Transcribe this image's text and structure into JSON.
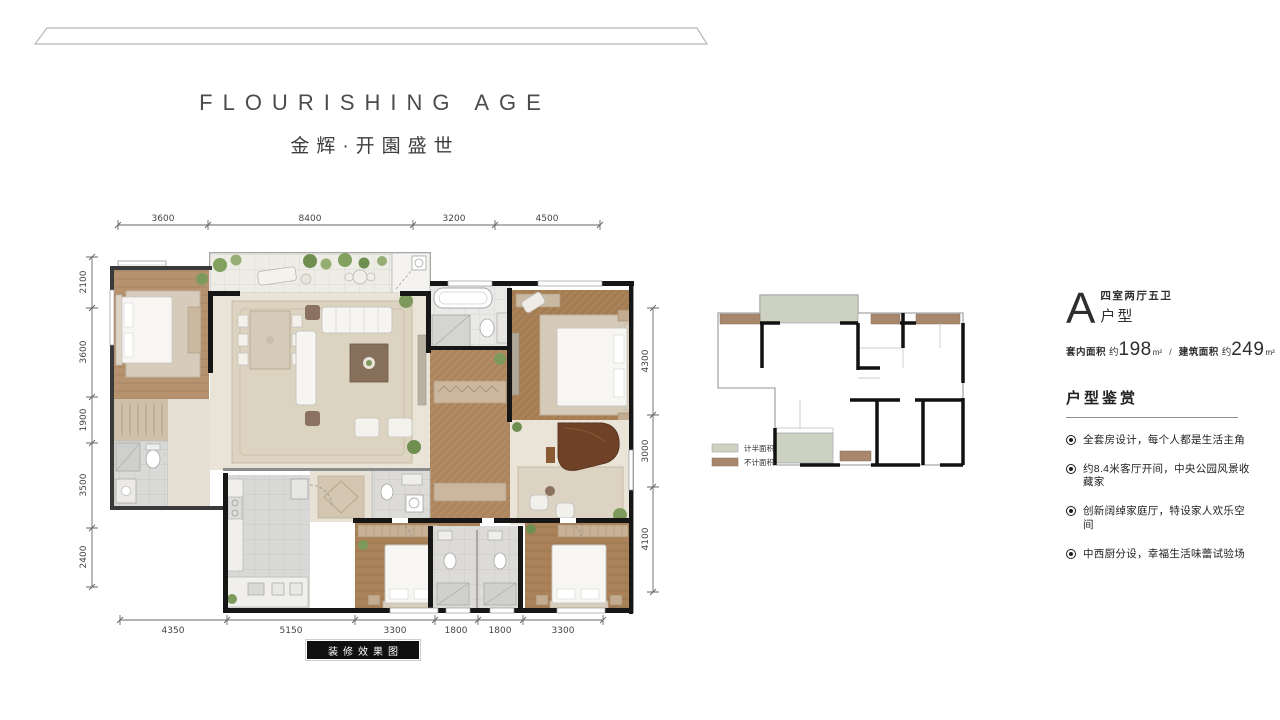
{
  "header": {
    "title_en": "FLOURISHING AGE",
    "title_cn": "金辉·开園盛世"
  },
  "plan": {
    "caption": "装修效果图",
    "dims_top": [
      "3600",
      "8400",
      "3200",
      "4500"
    ],
    "dims_left": [
      "2100",
      "3600",
      "1900",
      "3500",
      "2400"
    ],
    "dims_right": [
      "4300",
      "3000",
      "4100"
    ],
    "dims_bottom": [
      "4350",
      "5150",
      "3300",
      "1800",
      "1800",
      "3300"
    ]
  },
  "legend": {
    "items": [
      {
        "label": "计半面积",
        "color": "#ccd1c2"
      },
      {
        "label": "不计面积",
        "color": "#a8876c"
      }
    ]
  },
  "unit": {
    "letter": "A",
    "rooms": "四室两厅五卫",
    "label": "户型",
    "area_prefix_1": "套内面积",
    "area_approx_1": "约",
    "area_value_1": "198",
    "area_unit_1": "m²",
    "area_sep": "/",
    "area_prefix_2": "建筑面积",
    "area_approx_2": "约",
    "area_value_2": "249",
    "area_unit_2": "m²",
    "section_title": "户型鉴赏",
    "features": [
      "全套房设计，每个人都是生活主角",
      "约8.4米客厅开间，中央公园风景收藏家",
      "创新阔绰家庭厅，特设家人欢乐空间",
      "中西厨分设，幸福生活味蕾试验场"
    ]
  },
  "palette": {
    "wall": "#161616",
    "wood_light": "#b6926e",
    "wood_dark": "#aa8157",
    "living_floor": "#eae4d8",
    "tile_gray": "#d8d8d6"
  }
}
